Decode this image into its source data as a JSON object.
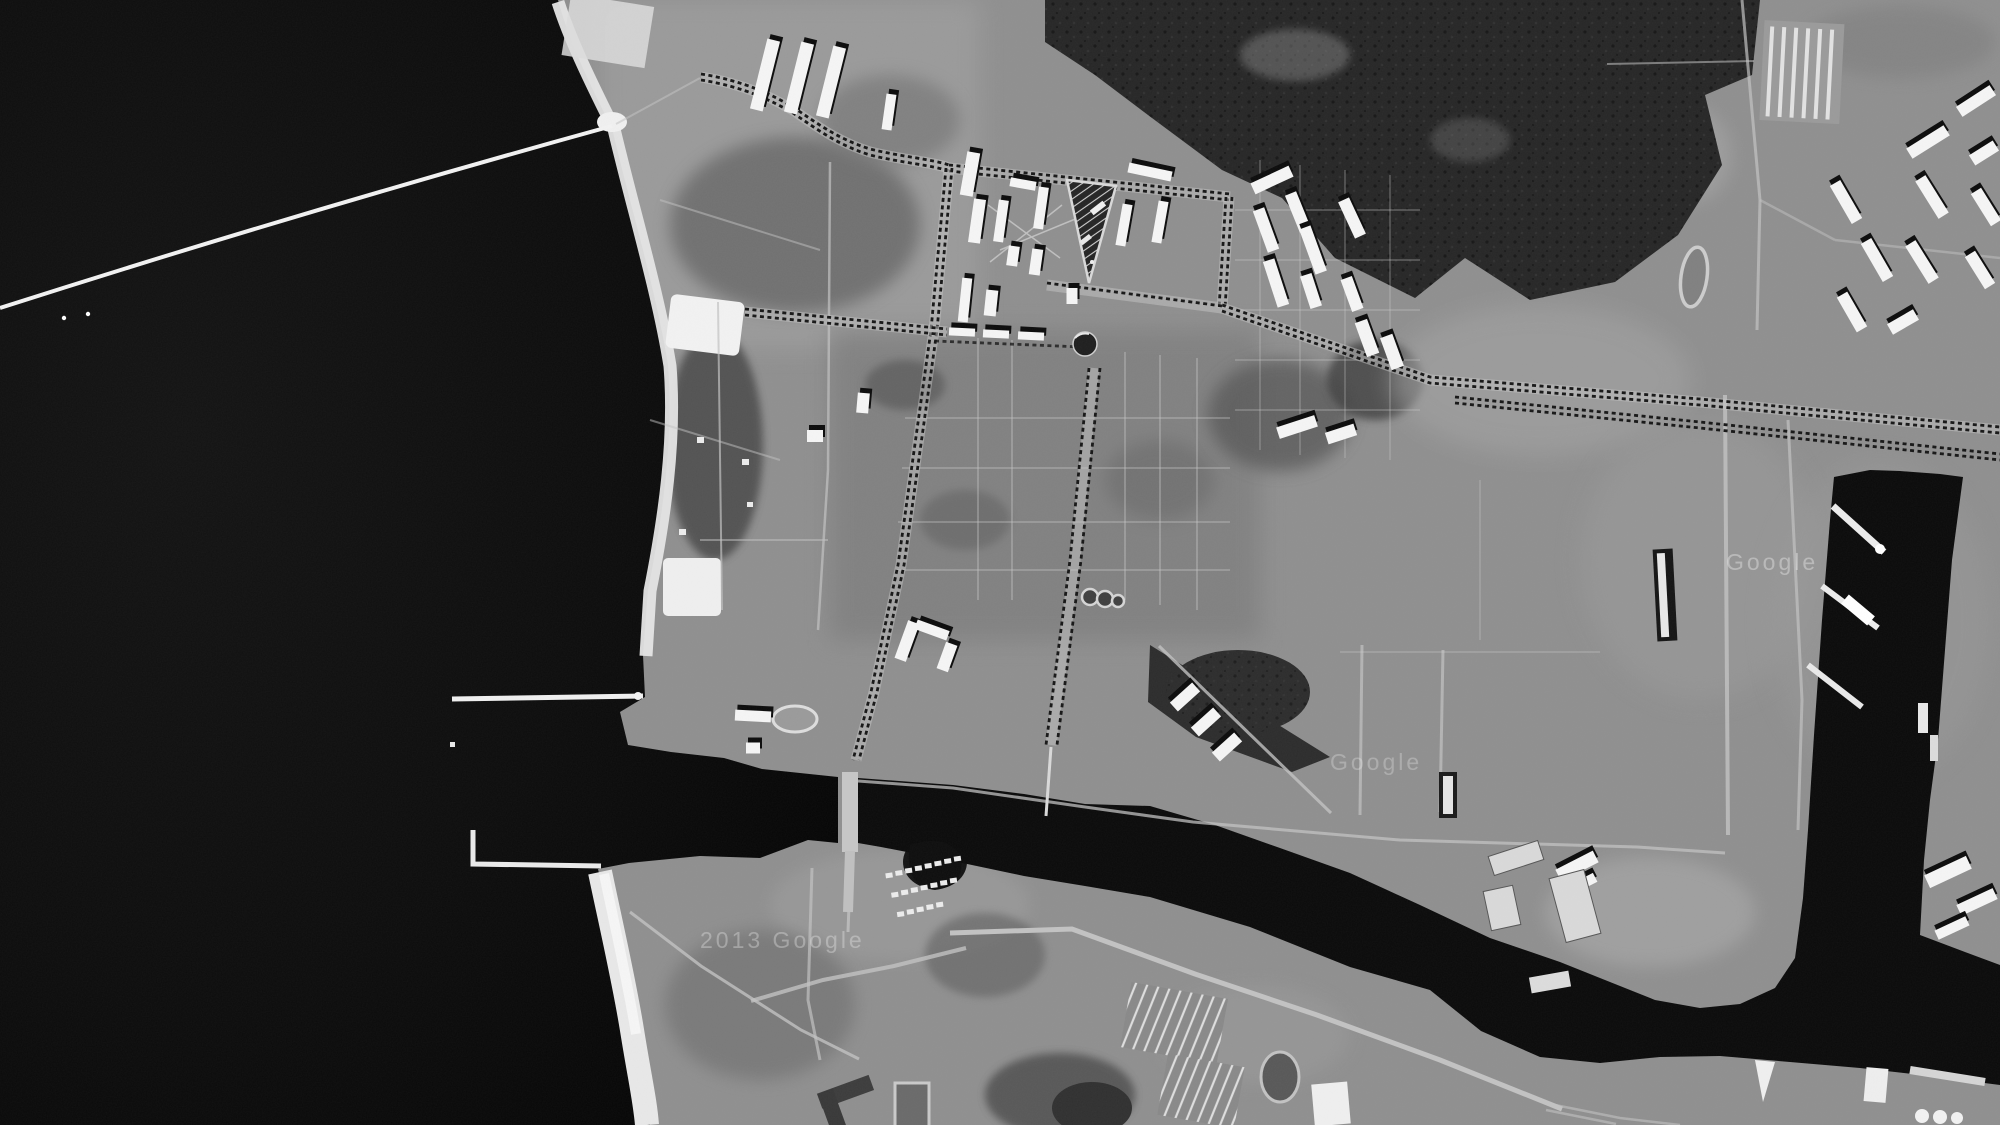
{
  "meta": {
    "image_kind": "grayscale aerial reconnaissance photograph",
    "scene": "coastal harbor town: sea with long breakwater at left, beach strip, gridded garrison town with tree-lined avenues and white barracks blocks, dark parade-ground triangle, winding dark river channel to docks, rectangular harbor basin with finger piers and moored ships, forest tracts, allotment strip fields and oil tanks"
  },
  "palette": {
    "sea": "#0e0e0e",
    "sea_deep": "#050505",
    "channel": "#0a0a0a",
    "land": "#8f8f8f",
    "land_light": "#a4a4a4",
    "land_dark": "#6f6f6f",
    "forest": "#262626",
    "scrub": "#4d4d4d",
    "beach": "#e8e8e8",
    "structure_white": "#f5f5f5",
    "shadow_black": "#0b0b0b",
    "road_light": "#c2c2c2",
    "avenue_dark": "#161616"
  },
  "watermarks": {
    "bottom_left": "2013 Google",
    "center": "Google",
    "dock": "Google"
  },
  "features": {
    "sea": "dark Baltic-like sea occupying left quarter",
    "breakwater": "thin white mole running from left edge to the shore",
    "beach": "bright sand strip along the whole west coast",
    "harbor_entrance": "north pier and south mole enclosing outer harbor",
    "river_channel": "dark tidal channel winding east to the docks",
    "bridge": "light causeway bridge crossing the channel",
    "dock_basin": "rectangular dark basin with three finger piers and moored ships",
    "town": "street grid with dark dotted tree-lined avenues",
    "parade_triangle": "dark hatched triangular parade ground",
    "barracks": "white barracks blocks casting hard black shadows",
    "forest": "dense dark woodland in the north-east",
    "allotments": "striped nursery fields south of the channel",
    "oil_tanks": "three round tanks at bottom right",
    "oval_track": "small oval track east of the forest"
  }
}
